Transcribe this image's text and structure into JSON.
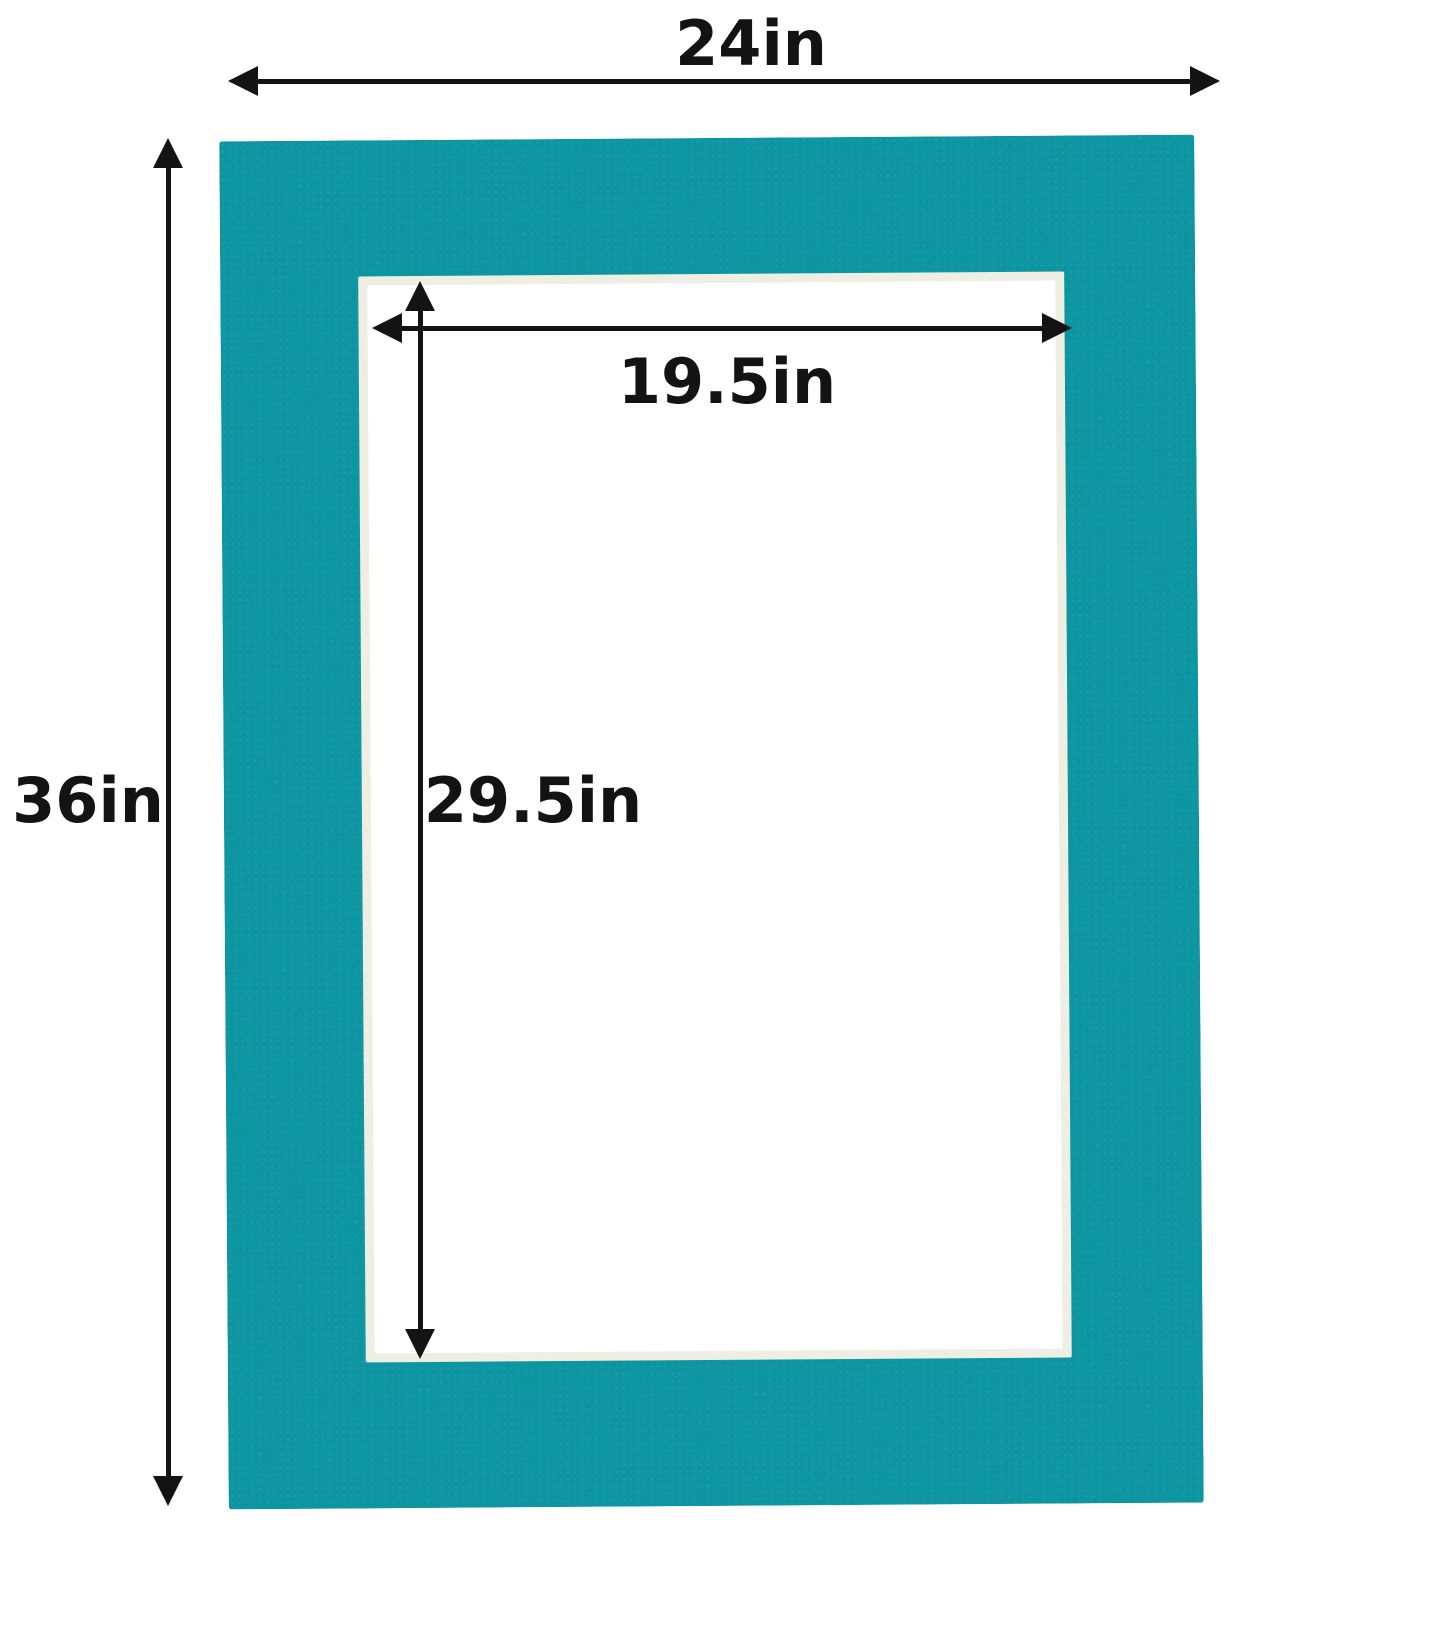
{
  "diagram": {
    "name": "mat-board-dimension-diagram",
    "description": "Teal picture mat with outer and opening dimension annotations",
    "colors": {
      "mat": "#0d96a1",
      "bevel": "#efeee3",
      "opening": "#ffffff",
      "background": "#ffffff",
      "annotation": "#131313"
    },
    "dimensions": {
      "outer_width": "24in",
      "outer_height": "36in",
      "opening_width": "19.5in",
      "opening_height": "29.5in"
    }
  }
}
